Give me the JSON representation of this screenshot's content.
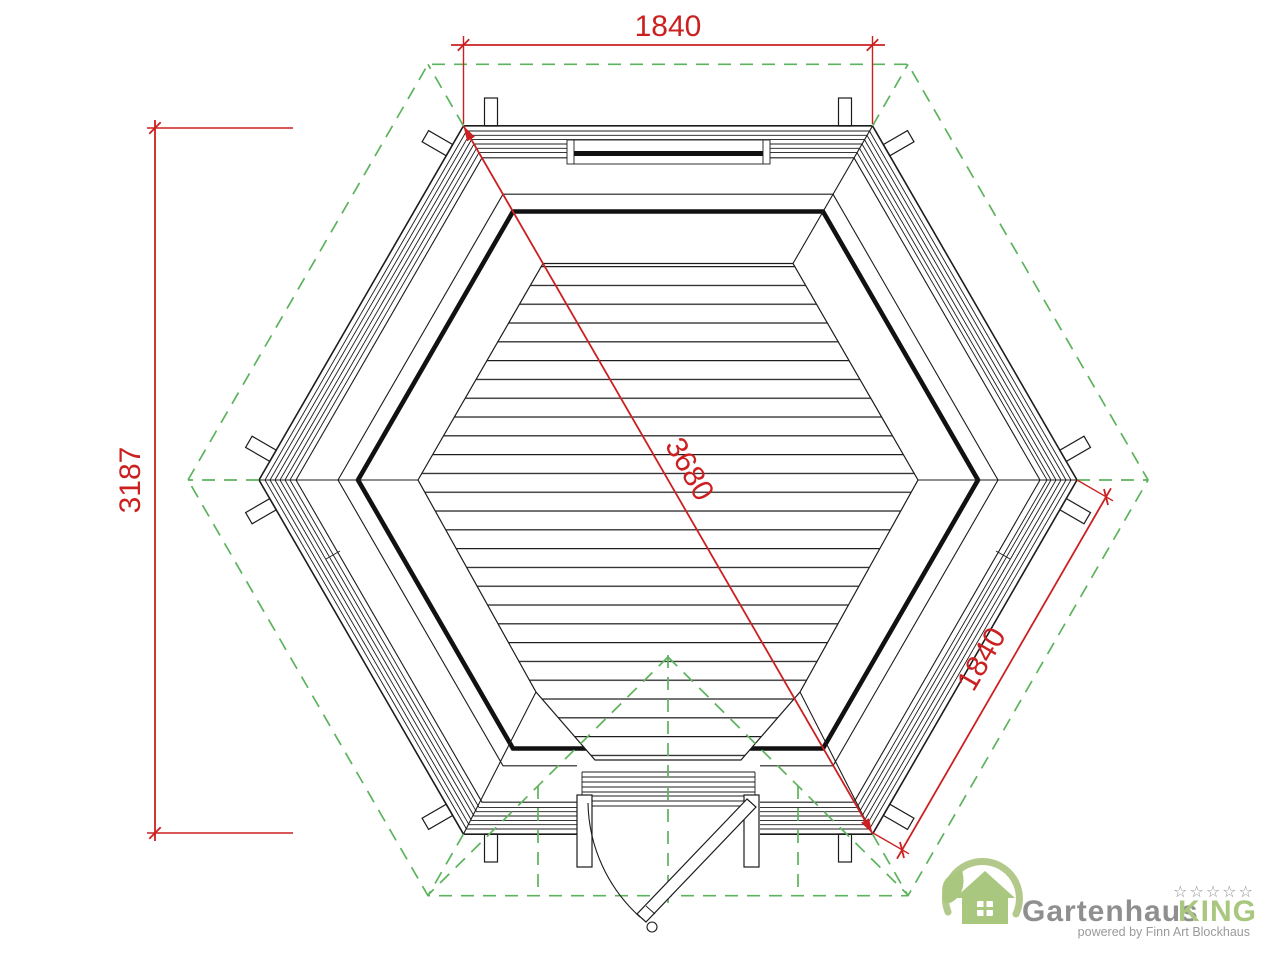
{
  "drawing": {
    "title": "hexagonal-pavilion-floor-plan",
    "dimensions": {
      "top_width": "1840",
      "left_height": "3187",
      "diagonal": "3680",
      "side_length": "1840"
    },
    "colors": {
      "dimension_red": "#cc2020",
      "roof_outline_green": "#5db35d",
      "drawing_black": "#1c1c1c"
    }
  },
  "logo": {
    "brand": "Gartenhaus",
    "brand_accent": "KING",
    "stars": "☆☆☆☆☆",
    "tagline": "powered by Finn Art Blockhaus",
    "colors": {
      "green": "#a9c77f",
      "gray": "#8f8f8f"
    }
  }
}
